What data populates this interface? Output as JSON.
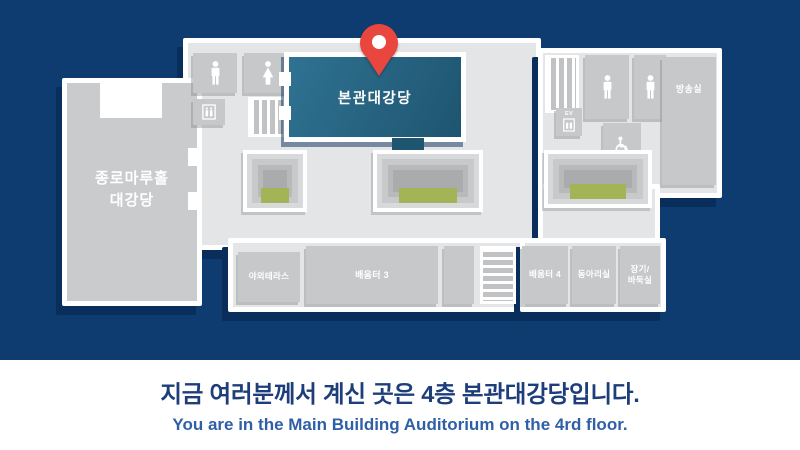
{
  "page": {
    "background_color": "#0e3b70",
    "panel_background": "#ffffff"
  },
  "floor_map": {
    "you_are_here_pin": {
      "icon": "map-pin-icon",
      "color": "#e8463e"
    },
    "current_room": {
      "label": "본관대강당",
      "color": "#25607e"
    },
    "left_hall": {
      "label": "종로마루홀\n대강당"
    },
    "rooms": {
      "broadcast_room": "방송실",
      "outdoor_terrace": "야외테라스",
      "learning_room_3": "배움터 3",
      "learning_room_4": "배움터 4",
      "club_room": "동아리실",
      "board_game_room": "장기/\n바둑실"
    },
    "elevator_label": "EV",
    "icons": {
      "male_restroom": "male-figure-icon",
      "female_restroom": "female-figure-icon",
      "accessible_restroom": "wheelchair-icon",
      "elevator": "elevator-icon",
      "stairs": "stairs-stripes-icon"
    },
    "accent_green": "#a2b455"
  },
  "caption": {
    "headline_ko": "지금 여러분께서 계신 곳은 4층 본관대강당입니다.",
    "subtitle_en": "You are in the Main Building Auditorium on the 4rd floor.",
    "headline_color": "#1d3e7a",
    "subtitle_color": "#2f5fa7"
  }
}
